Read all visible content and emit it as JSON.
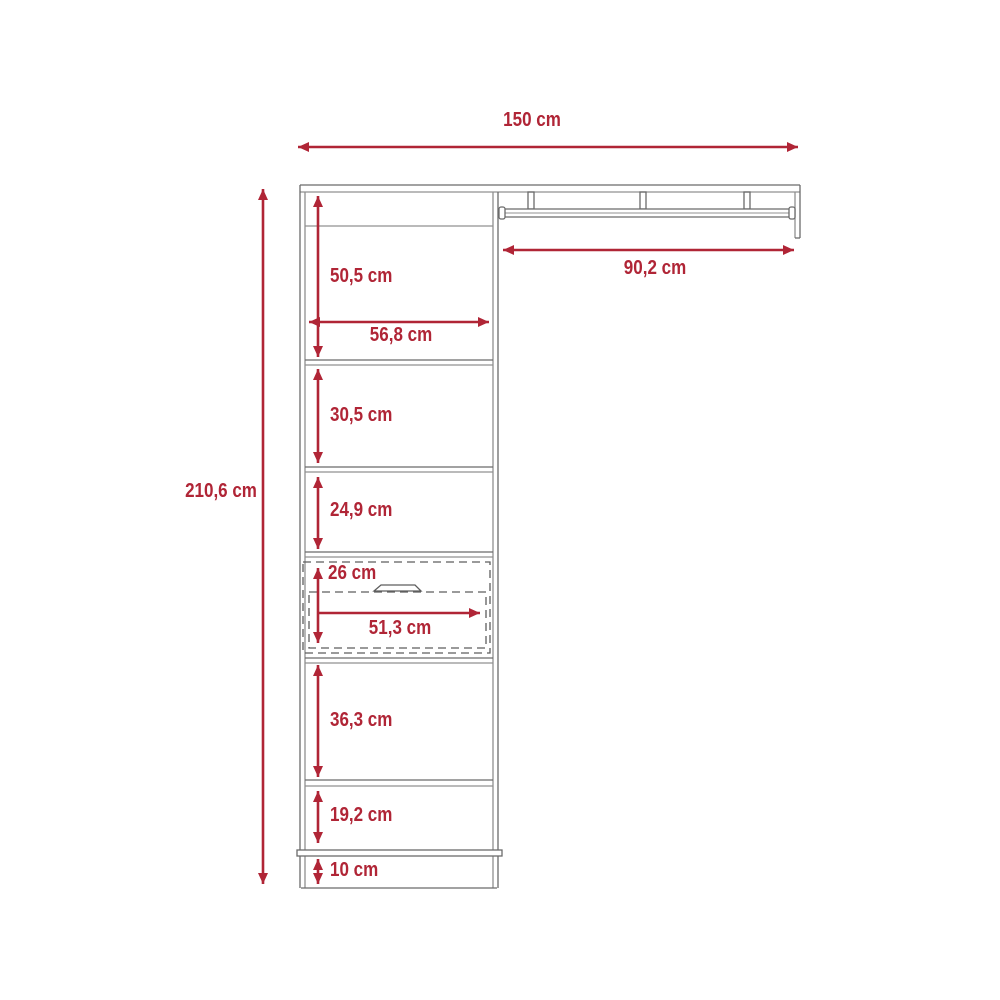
{
  "diagram": {
    "type": "furniture-technical-drawing",
    "subject": "closet organizer with shelves, drawer and hanging rod",
    "unit": "cm",
    "colors": {
      "dimension_red": "#B02536",
      "line_gray": "#6B6B6B",
      "line_gray_light": "#909090",
      "background": "#FFFFFF"
    },
    "dimensions": {
      "overall_width": "150 cm",
      "overall_height": "210,6 cm",
      "rod_section_width": "90,2 cm",
      "top_section_height": "50,5 cm",
      "interior_width": "56,8 cm",
      "second_section_height": "30,5 cm",
      "third_section_height": "24,9 cm",
      "drawer_front_height": "26 cm",
      "drawer_interior_width": "51,3 cm",
      "lower_section_height": "36,3 cm",
      "bottom_shelf_height": "19,2 cm",
      "base_height": "10 cm"
    }
  }
}
